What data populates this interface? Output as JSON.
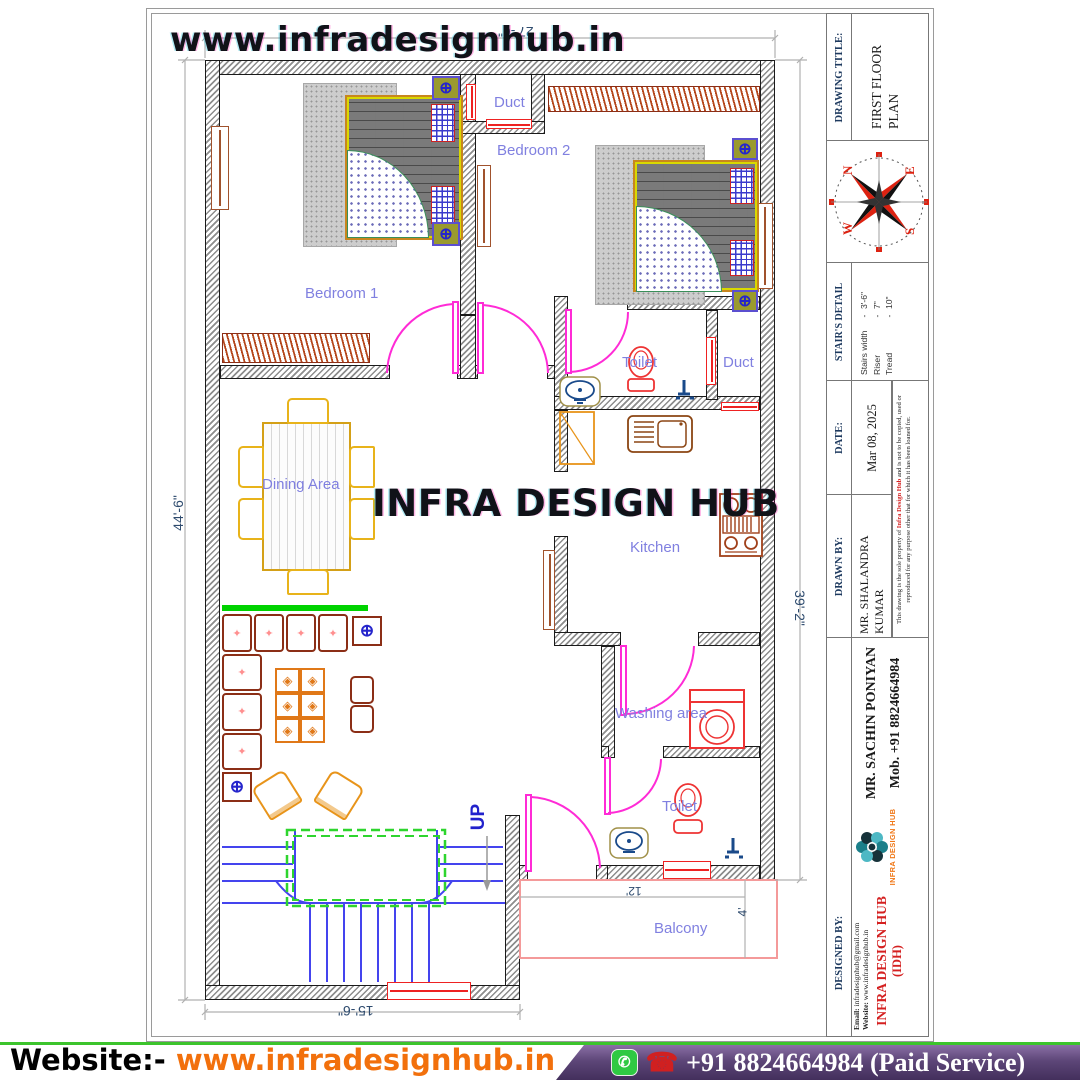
{
  "watermarks": {
    "top": "www.infradesignhub.in",
    "center": "INFRA DESIGN HUB"
  },
  "rooms": {
    "bedroom1": "Bedroom 1",
    "bedroom2": "Bedroom 2",
    "duct_top": "Duct",
    "duct_mid": "Duct",
    "toilet_mid": "Toilet",
    "kitchen": "Kitchen",
    "dining": "Dining Area",
    "washing": "Washing area",
    "toilet_bottom": "Toilet",
    "balcony": "Balcony",
    "up": "UP"
  },
  "dimensions": {
    "top": "27'-6\"",
    "left": "44'-6\"",
    "right": "39'-2\"",
    "bottom": "15'-6\"",
    "balcony_width": "12'",
    "balcony_depth": "4'"
  },
  "title_block": {
    "drawing_title_label": "DRAWING TITLE:",
    "drawing_title_line1": "FIRST FLOOR",
    "drawing_title_line2": "PLAN",
    "compass": {
      "n": "N",
      "e": "E",
      "s": "S",
      "w": "W"
    },
    "stairs_label": "STAIR'S DETAIL",
    "stairs": [
      {
        "label": "Stairs width",
        "sep": "-",
        "value": "3'-6\""
      },
      {
        "label": "Riser",
        "sep": "-",
        "value": "7\""
      },
      {
        "label": "Tread",
        "sep": "-",
        "value": "10\""
      }
    ],
    "date_label": "DATE:",
    "date_value": "Mar 08, 2025",
    "drawn_by_label": "DRAWN BY:",
    "drawn_by_line1": "MR. SHALANDRA",
    "drawn_by_line2": "KUMAR",
    "disclaimer_pre": "This drawing is the sole property of ",
    "disclaimer_brand": "Infra Design Hub",
    "disclaimer_post": " and is not to be copied, used or reproduced for any purpose other that for which it has been loaned for.",
    "designed_by_label": "DESIGNED BY:",
    "designer_name": "MR. SACHIN PONIYAN",
    "designer_mobile": "Mob. +91 8824664984",
    "logo_text": "INFRA DESIGN HUB",
    "company_name": "INFRA DESIGN HUB",
    "company_abbr": "(IDH)",
    "email_label": "Email:",
    "email": "infradesignhub@gmail.com",
    "website_label": "Website:",
    "website": "www.infradesignhub.in"
  },
  "footer": {
    "website_label": "Website:-",
    "website": "www.infradesignhub.in",
    "phone": "+91 8824664984 (Paid Service)"
  }
}
